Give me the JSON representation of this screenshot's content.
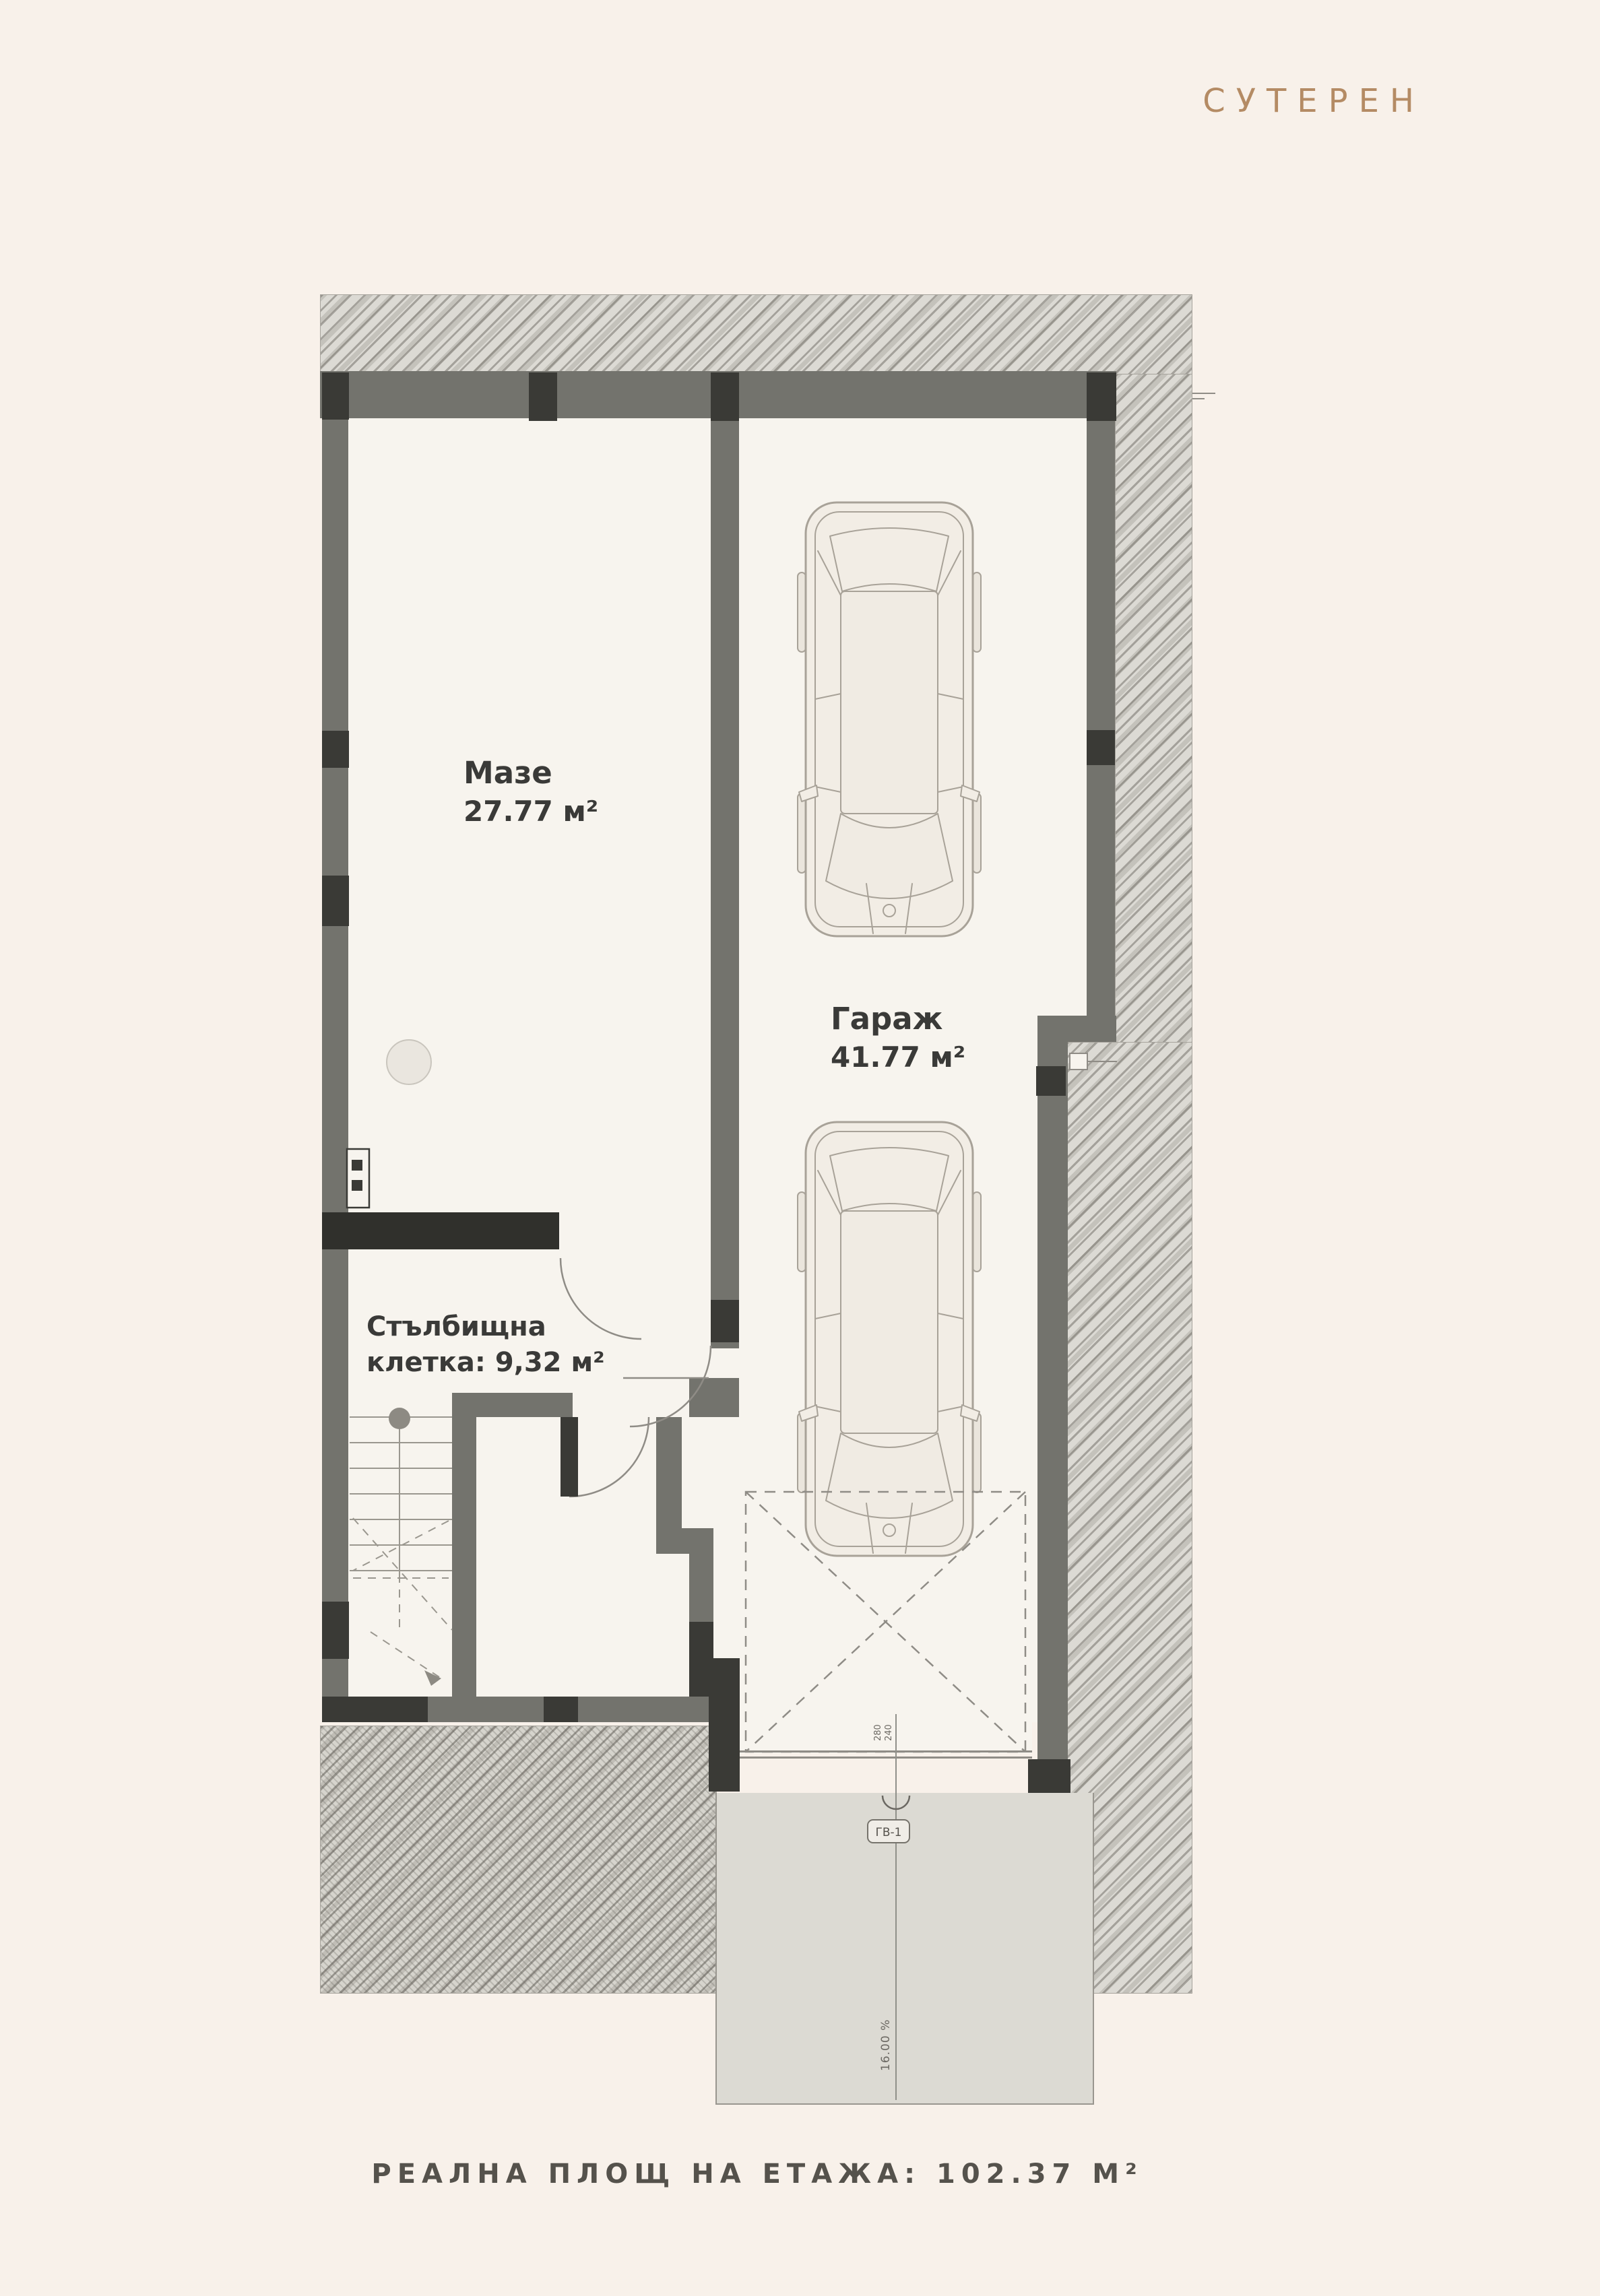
{
  "title": "СУТЕРЕН",
  "rooms": {
    "maze": {
      "name": "Мазе",
      "area": "27.77 м²"
    },
    "garage": {
      "name": "Гараж",
      "area": "41.77 м²"
    },
    "staircase": {
      "name": "Стълбищна",
      "area": "клетка: 9,32 м²"
    }
  },
  "annotations": {
    "garage_door_label": "ГВ-1",
    "slope_label": "16.00 %",
    "dim_left": "280",
    "dim_right": "240"
  },
  "footer": {
    "label": "РЕАЛНА ПЛОЩ НА ЕТАЖА: 102.37 М²"
  },
  "colors": {
    "accent": "#b48b64",
    "background": "#f8f1ea",
    "interior": "#f7f4ee",
    "wall": "#73736d",
    "wall_dark": "#3a3a36",
    "hatch": "#dcdad4",
    "driveway": "#dcdad3",
    "label_text": "#3a3a38",
    "footer_text": "#55524c"
  }
}
